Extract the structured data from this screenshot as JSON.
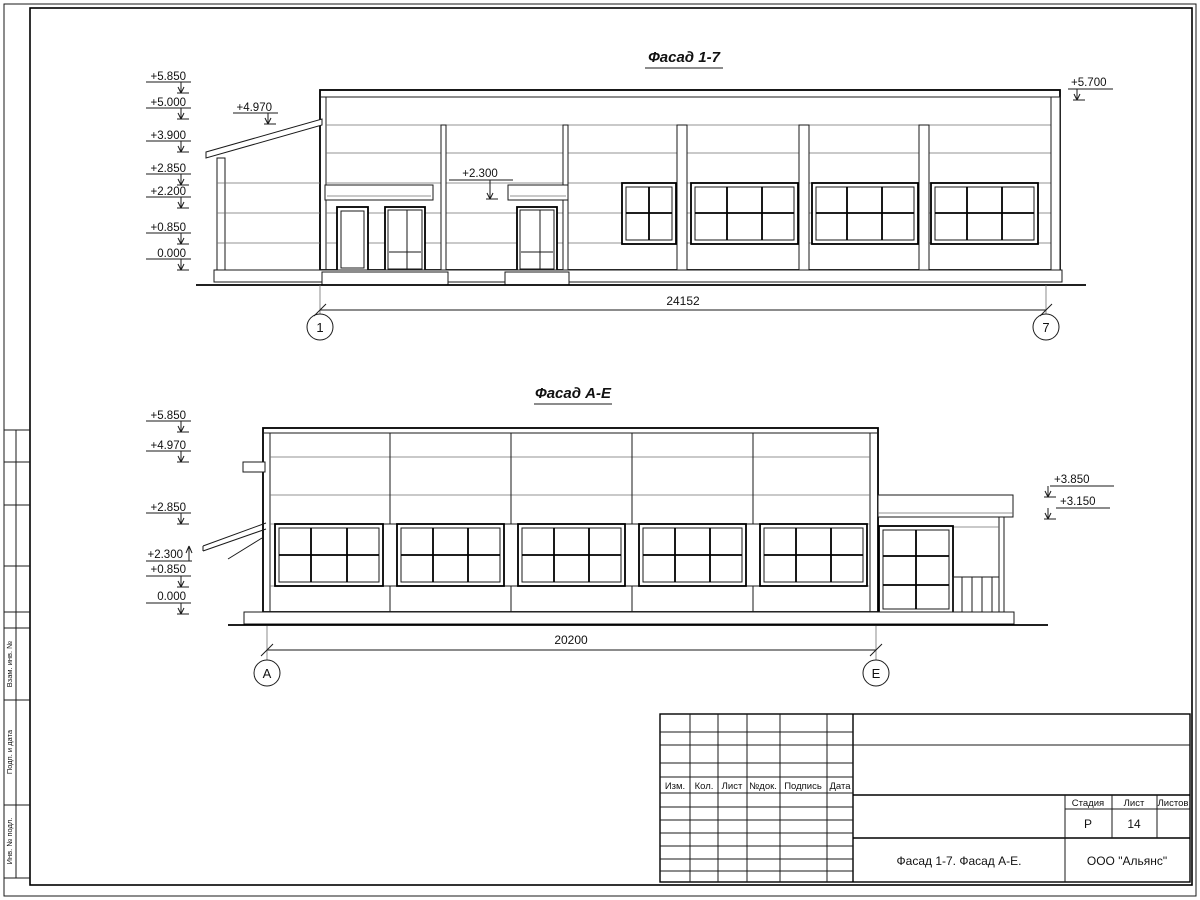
{
  "facade1": {
    "title": "Фасад 1-7",
    "marks_left": [
      "+5.850",
      "+5.000",
      "+3.900",
      "+2.850",
      "+2.200",
      "+0.850",
      "0.000"
    ],
    "mark_roof": "+4.970",
    "mark_door": "+2.300",
    "mark_right": "+5.700",
    "dim": "24152",
    "axis_a": "1",
    "axis_b": "7"
  },
  "facade2": {
    "title": "Фасад А-Е",
    "marks_left": [
      "+5.850",
      "+4.970",
      "+2.850",
      "+2.300",
      "+0.850",
      "0.000"
    ],
    "marks_right": [
      "+3.850",
      "+3.150"
    ],
    "dim": "20200",
    "axis_a": "А",
    "axis_b": "Е"
  },
  "strip": {
    "labels": [
      "Взам. инв. №",
      "Подп. и дата",
      "Инв. № подл."
    ]
  },
  "stamp": {
    "cols": [
      "Изм.",
      "Кол.",
      "Лист",
      "№док.",
      "Подпись",
      "Дата"
    ],
    "stage_label": "Стадия",
    "sheet_label": "Лист",
    "sheets_label": "Листов",
    "stage": "Р",
    "sheet_num": "14",
    "title": "Фасад 1-7. Фасад А-Е.",
    "company": "ООО \"Альянс\""
  }
}
